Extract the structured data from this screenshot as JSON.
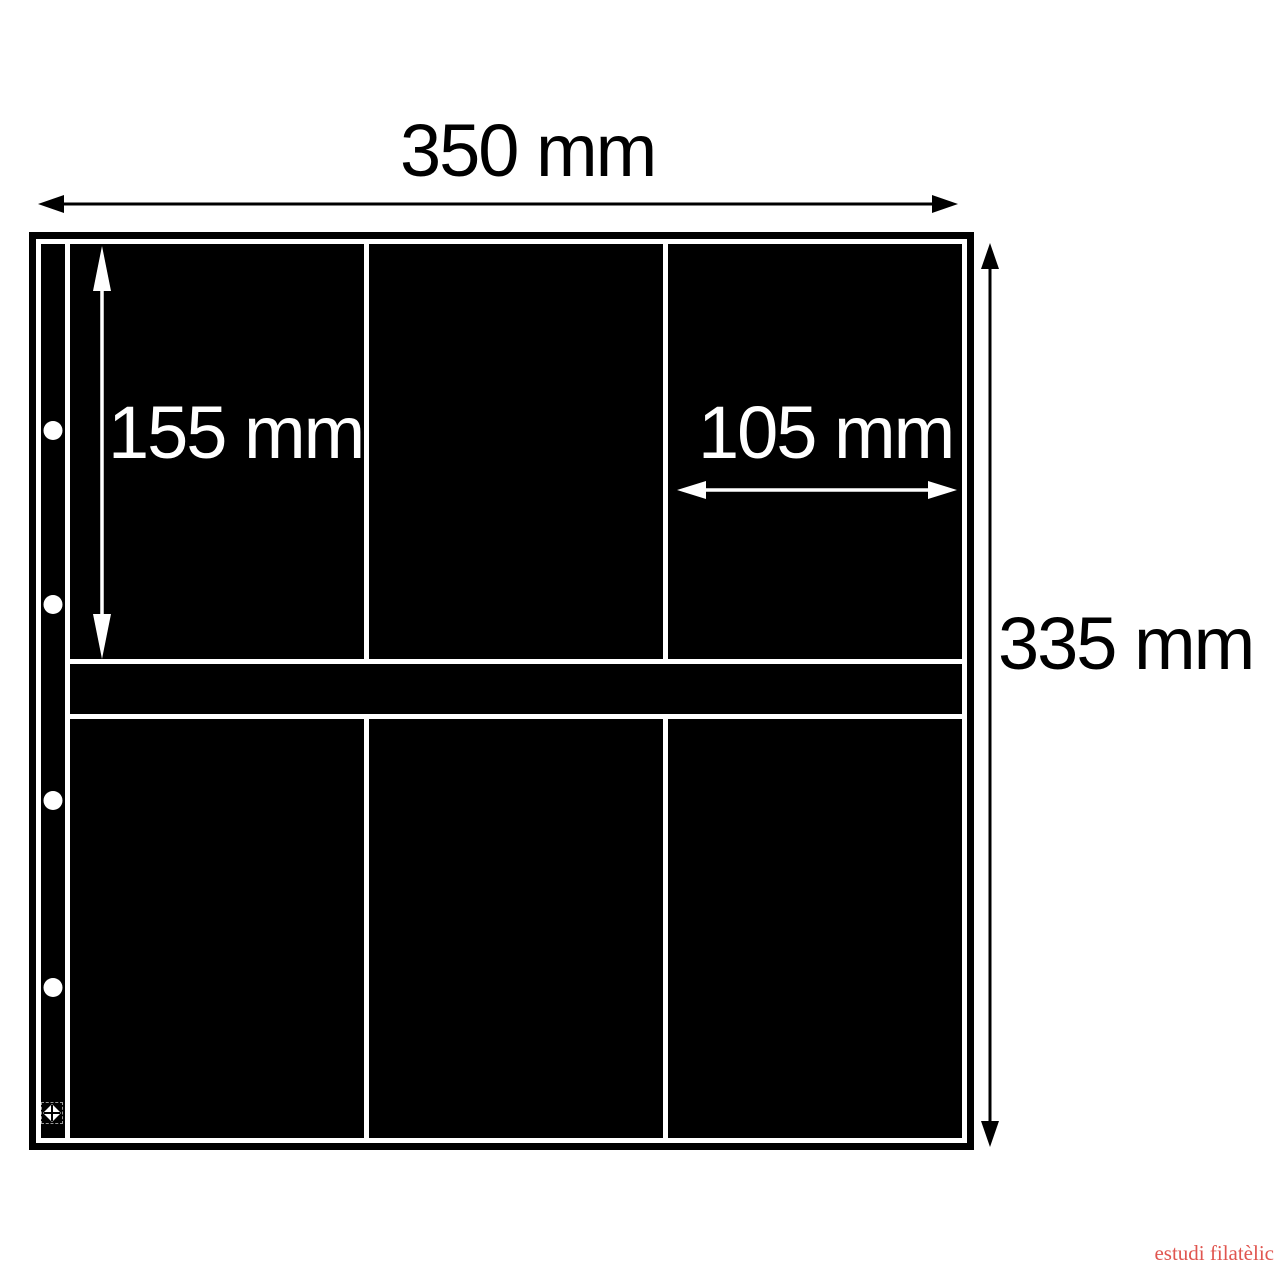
{
  "diagram": {
    "width_label": "350 mm",
    "height_label": "335 mm",
    "pocket_height_label": "155 mm",
    "pocket_width_label": "105 mm"
  },
  "sheet": {
    "color": "#000000",
    "divider_line_color": "#ffffff",
    "rows": 2,
    "columns": 3,
    "pocket_count": 6,
    "punch_hole_count": 4
  },
  "icons": {
    "width_arrow": "double-arrow-horizontal-black",
    "height_arrow": "double-arrow-vertical-black",
    "pocket_height_arrow": "double-arrow-vertical-white",
    "pocket_width_arrow": "double-arrow-horizontal-white",
    "punch_hole": "white-circle",
    "registration_mark": "quartered-diamond"
  },
  "watermark": {
    "text": "estudi filatèlic",
    "color": "#e0554f"
  }
}
